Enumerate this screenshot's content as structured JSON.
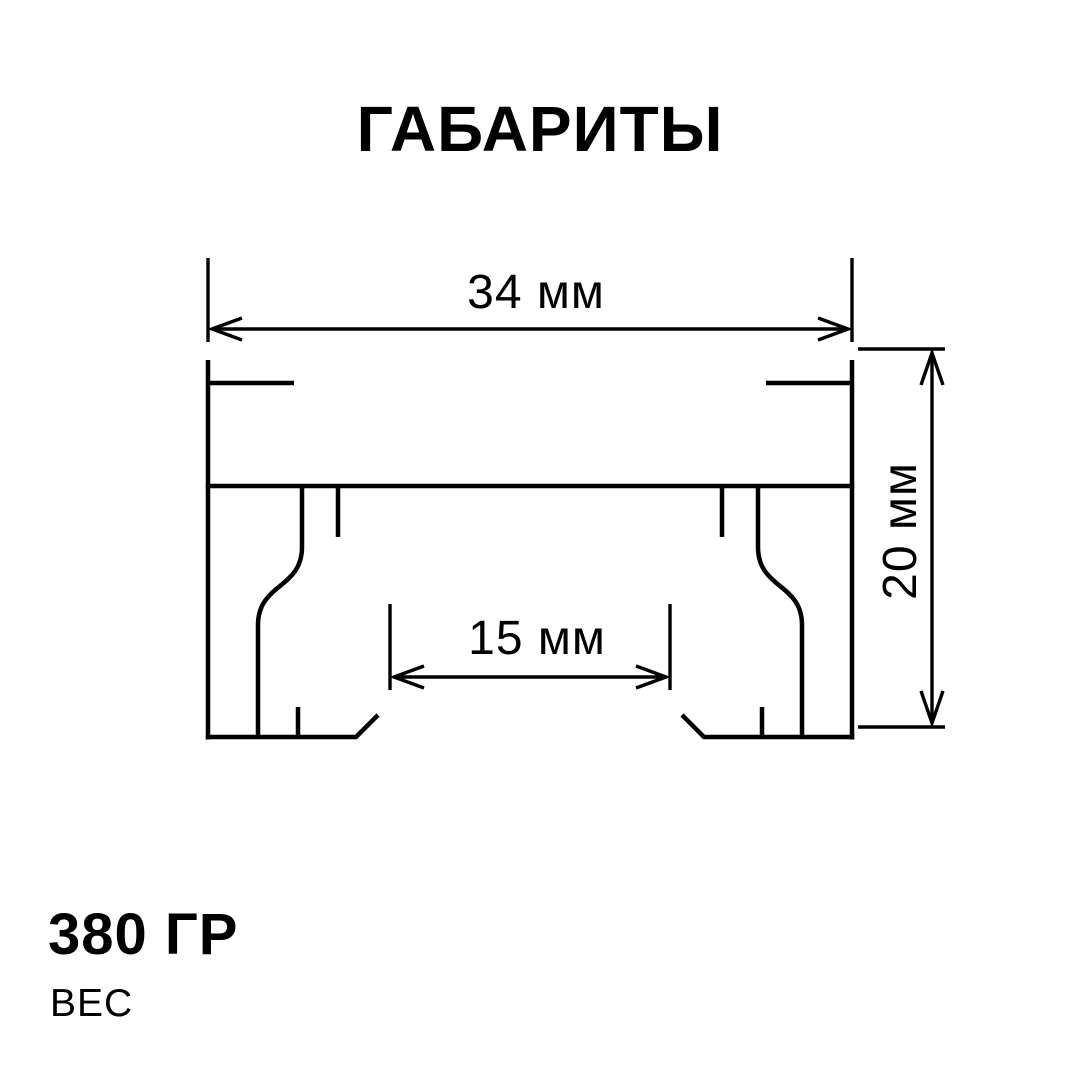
{
  "title": "ГАБАРИТЫ",
  "drawing": {
    "type": "profile-cross-section",
    "dimensions": {
      "width_label": "34 мм",
      "height_label": "20 мм",
      "inner_width_label": "15 мм"
    }
  },
  "weight": {
    "value": "380 ГР",
    "label": "ВЕС"
  },
  "colors": {
    "line": "#000000",
    "text": "#000000",
    "background": "#ffffff"
  }
}
